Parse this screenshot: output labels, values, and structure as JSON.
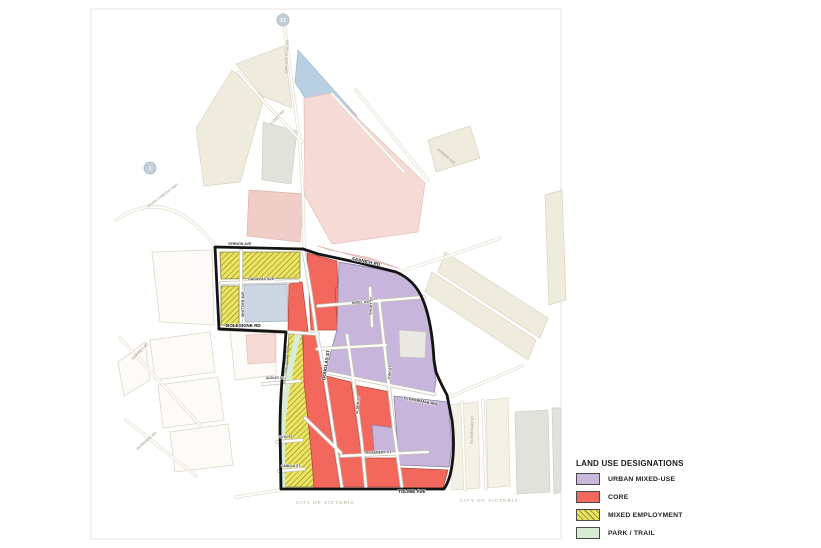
{
  "legend": {
    "title": "LAND USE DESIGNATIONS",
    "items": [
      {
        "label": "URBAN MIXED-USE",
        "color": "#c9b9dc",
        "hatch": false
      },
      {
        "label": "CORE",
        "color": "#f4695e",
        "hatch": false
      },
      {
        "label": "MIXED EMPLOYMENT",
        "color": "#e9e460",
        "hatch": true
      },
      {
        "label": "PARK / TRAIL",
        "color": "#d9ecd5",
        "hatch": false
      }
    ]
  },
  "map": {
    "labels": {
      "vernon": "VERNON AVE",
      "cadillac": "CADILLAC AVE",
      "whittier": "WHITTIER AVE",
      "boleskine": "BOLESKINE RD",
      "saanich": "SAANICH RD",
      "douglas": "DOUGLAS ST",
      "nigel": "NIGEL AVE",
      "short": "SHORT ST",
      "oak": "OAK ST",
      "alder": "ALDER ST",
      "cloverdale": "CLOVERDALE AVE",
      "rosebery": "ROSEBERY ST",
      "audley": "AUDLEY ST",
      "glyn": "GLYN ST",
      "camilla": "CAMILLA ST",
      "tolmie": "TOLMIE AVE",
      "goose": "GALLOPING GOOSE TRAIL",
      "patricia_bay": "PATRICIA BAY HWY",
      "trans_canada": "TRANS CANADA HWY",
      "carey": "CAREY RD",
      "darwin": "DARWIN AVE",
      "harriet": "HARRIET RD",
      "burnside": "BURNSIDE RD",
      "blanshard": "BLANSHARD ST",
      "city_of_victoria_1": "CITY OF VICTORIA",
      "city_of_victoria_2": "CITY OF VICTORIA"
    },
    "shields": {
      "hwy17": "17",
      "hwy1": "1"
    },
    "colors": {
      "urban_mixed_use": "#c7b5db",
      "core": "#f2685c",
      "mixed_employment": "#eae45f",
      "park_trail": "#d9ecd6",
      "plan_boundary": "#141414",
      "outside_pink": "#f5dad5",
      "outside_blue": "#b9cfe2",
      "outside_cream": "#efebdd"
    }
  }
}
